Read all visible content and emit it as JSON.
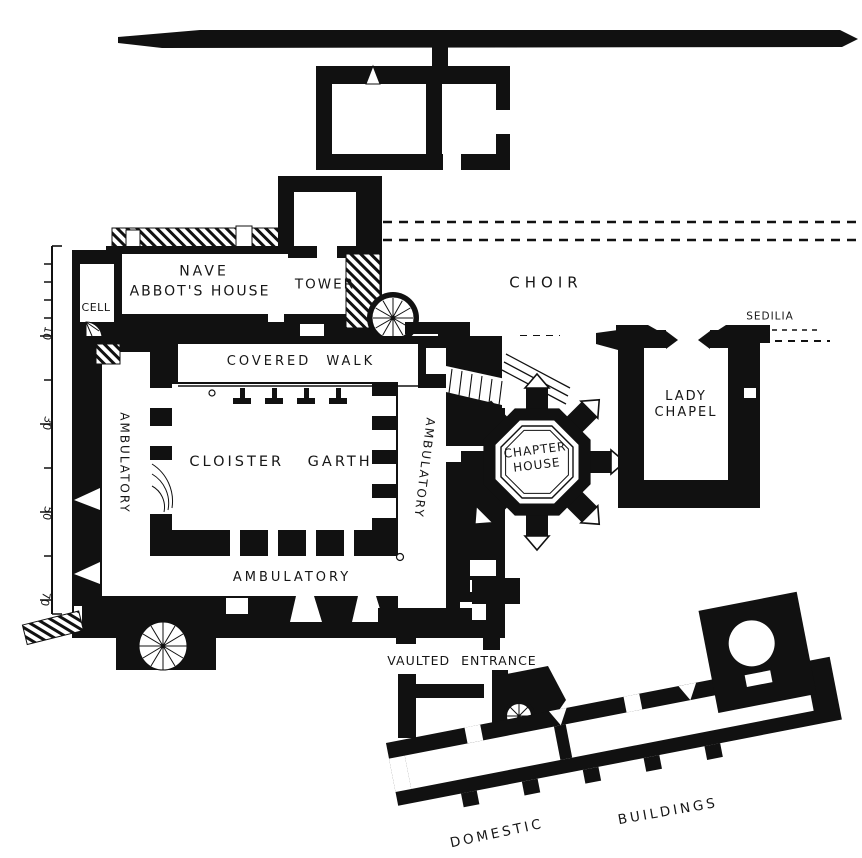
{
  "plan": {
    "rooms": {
      "nave_line1": "NAVE",
      "nave_line2": "ABBOT'S HOUSE",
      "cell": "CELL",
      "tower": "TOWER",
      "choir": "CHOIR",
      "sedilia": "SEDILIA",
      "covered_walk": "COVERED WALK",
      "ambulatory_west": "AMBULATORY",
      "ambulatory_east": "AMBULATORY",
      "ambulatory_south": "AMBULATORY",
      "cloister_garth": "CLOISTER GARTH",
      "chapter_house_line1": "CHAPTER",
      "chapter_house_line2": "HOUSE",
      "lady_chapel_line1": "LADY",
      "lady_chapel_line2": "CHAPEL",
      "vaulted_entrance": "VAULTED ENTRANCE",
      "domestic": "DOMESTIC",
      "buildings": "BUILDINGS"
    },
    "scale_bar": {
      "ticks": [
        "10",
        "30",
        "50",
        "70"
      ]
    },
    "colors": {
      "ink": "#111111",
      "paper": "#ffffff"
    }
  }
}
